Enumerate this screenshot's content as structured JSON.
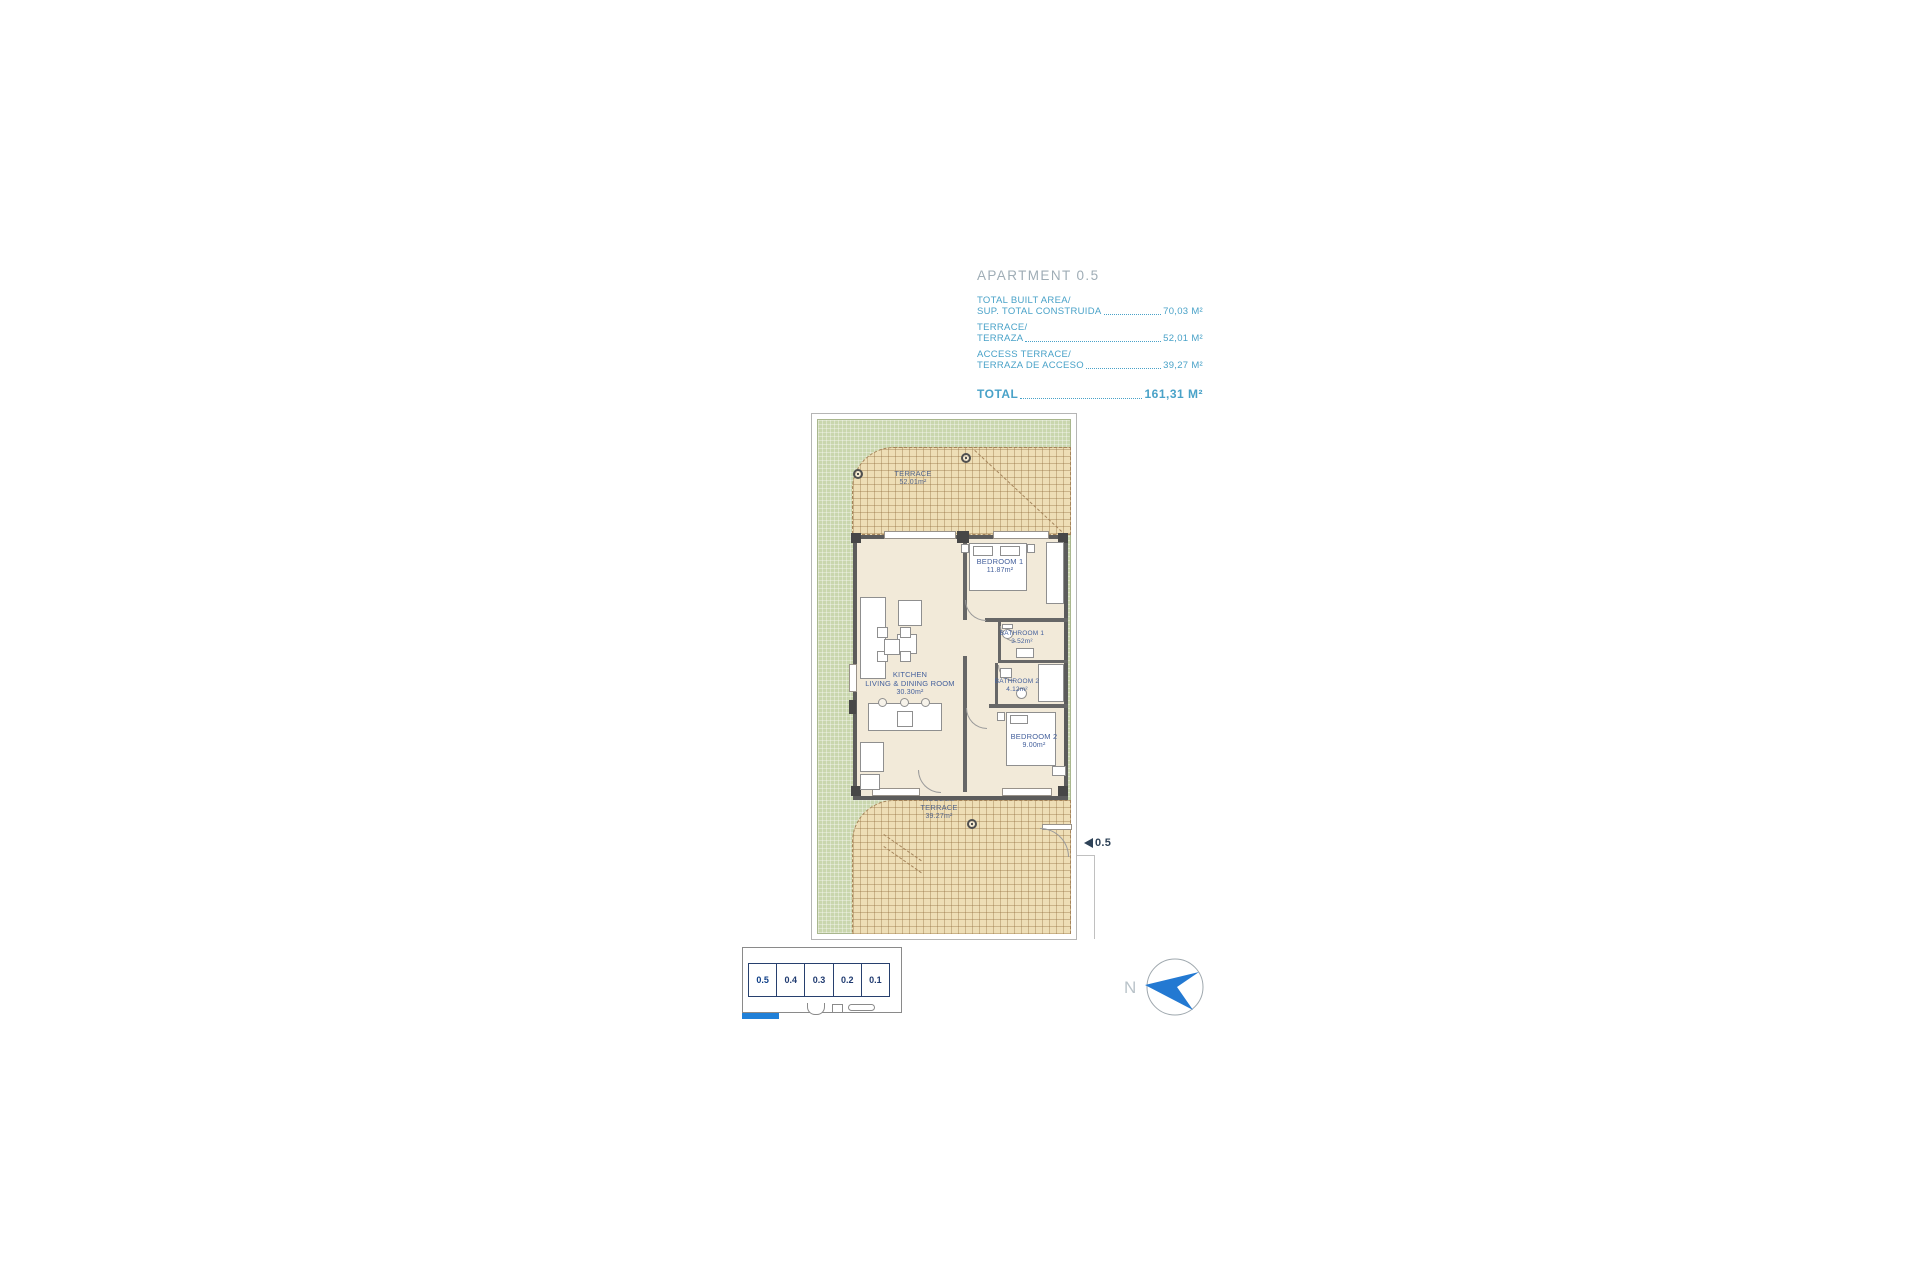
{
  "header": {
    "title": "APARTMENT 0.5",
    "area_rows": [
      {
        "line1": "TOTAL BUILT AREA/",
        "line2": "SUP. TOTAL CONSTRUIDA",
        "value": "70,03 M²"
      },
      {
        "line1": "TERRACE/",
        "line2": "TERRAZA",
        "value": "52,01 M²"
      },
      {
        "line1": "ACCESS TERRACE/",
        "line2": "TERRAZA DE ACCESO",
        "value": "39,27 M²"
      }
    ],
    "total": {
      "label": "TOTAL",
      "value": "161,31 M²"
    }
  },
  "plan": {
    "terrace": {
      "name": "TERRACE",
      "area": "52.01m²"
    },
    "bedroom1": {
      "name": "BEDROOM 1",
      "area": "11.87m²"
    },
    "bathroom1": {
      "name": "BATHROOM 1",
      "area": "3.52m²"
    },
    "bathroom2": {
      "name": "BATHROOM 2",
      "area": "4.12m²"
    },
    "kitchen": {
      "name1": "KITCHEN",
      "name2": "LIVING & DINING ROOM",
      "area": "30.30m²"
    },
    "bedroom2": {
      "name": "BEDROOM 2",
      "area": "9.00m²"
    },
    "access_terrace": {
      "name1": "ACCESS",
      "name2": "TERRACE",
      "area": "39.27m²"
    },
    "unit_marker": "0.5"
  },
  "keyplan": {
    "units": [
      {
        "label": "0.5",
        "highlighted": true
      },
      {
        "label": "0.4",
        "highlighted": false
      },
      {
        "label": "0.3",
        "highlighted": false
      },
      {
        "label": "0.2",
        "highlighted": false
      },
      {
        "label": "0.1",
        "highlighted": false
      }
    ]
  },
  "compass": {
    "north_label": "N"
  },
  "colors": {
    "accent_cyan": "#49a2c8",
    "muted_title_grey": "#9fadb6",
    "plan_green": "#c9d6ad",
    "terrace_tan": "#eedeb6",
    "wall_grey": "#5c5c5c",
    "room_label_blue": "#44609c",
    "keyplan_blue": "#2080d8",
    "marker_navy": "#2e4257"
  }
}
